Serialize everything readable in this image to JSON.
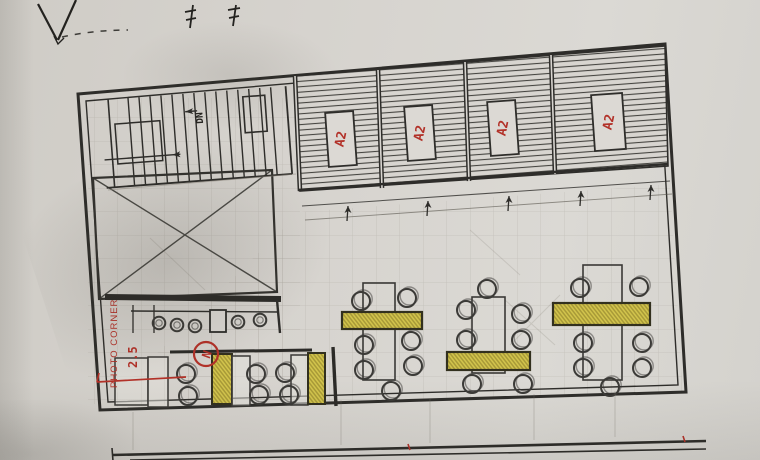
{
  "plan": {
    "rooms": [
      {
        "label": "A2"
      },
      {
        "label": "A2"
      },
      {
        "label": "A2"
      },
      {
        "label": "A2"
      }
    ],
    "stair": {
      "direction_label": "DN"
    },
    "photo_corner": {
      "label": "PHOTO CORNER",
      "dimension": "2.5"
    },
    "marker": {
      "label": "N"
    },
    "colors": {
      "paper": "#d6d3cd",
      "ink": "#2e2d2a",
      "pencil": "#8b867c",
      "bench_yellow": "#d5c74e",
      "annotation_red": "#b23128"
    }
  }
}
